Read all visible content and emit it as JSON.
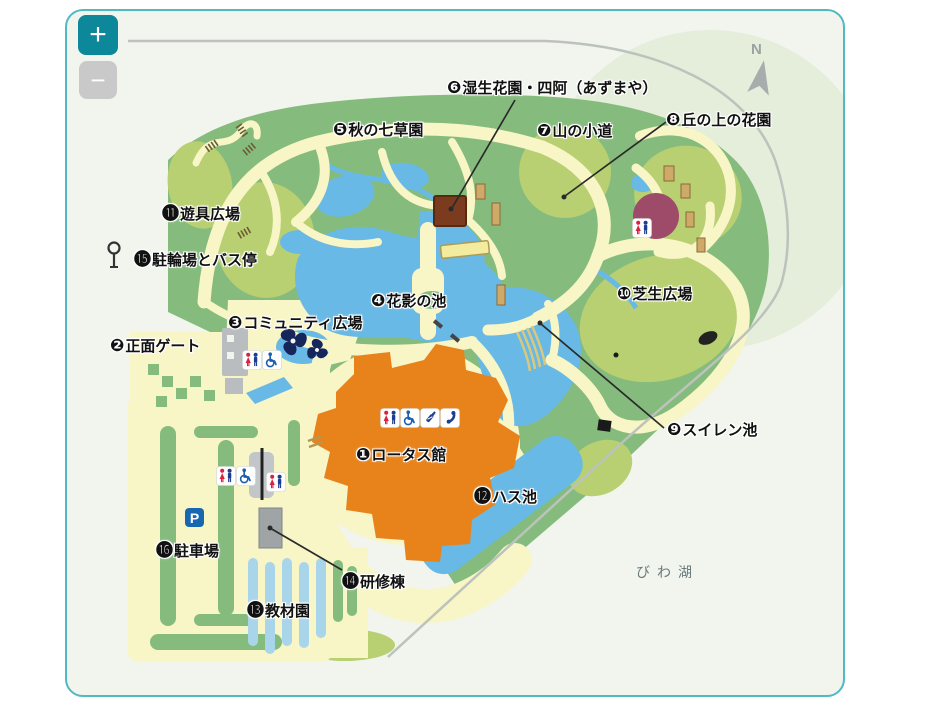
{
  "widget": {
    "zoom_in_label": "+",
    "zoom_out_label": "−"
  },
  "compass": {
    "letter": "N"
  },
  "map": {
    "parking_sign": "P",
    "lake_label": {
      "text": "びわ湖",
      "x": 636,
      "y": 562
    },
    "labels": [
      {
        "id": 1,
        "glyph": "❶",
        "text": "ロータス館",
        "x": 356,
        "y": 444
      },
      {
        "id": 2,
        "glyph": "❷",
        "text": "正面ゲート",
        "x": 110,
        "y": 335
      },
      {
        "id": 3,
        "glyph": "❸",
        "text": "コミュニティ広場",
        "x": 228,
        "y": 312
      },
      {
        "id": 4,
        "glyph": "❹",
        "text": "花影の池",
        "x": 371,
        "y": 290
      },
      {
        "id": 5,
        "glyph": "❺",
        "text": "秋の七草園",
        "x": 333,
        "y": 119
      },
      {
        "id": 6,
        "glyph": "❻",
        "text": "湿生花園・四阿（あずまや）",
        "x": 447,
        "y": 77
      },
      {
        "id": 7,
        "glyph": "❼",
        "text": "山の小道",
        "x": 537,
        "y": 120
      },
      {
        "id": 8,
        "glyph": "❽",
        "text": "丘の上の花園",
        "x": 666,
        "y": 109
      },
      {
        "id": 9,
        "glyph": "❾",
        "text": "スイレン池",
        "x": 667,
        "y": 419
      },
      {
        "id": 10,
        "glyph": "❿",
        "text": "芝生広場",
        "x": 617,
        "y": 283
      },
      {
        "id": 11,
        "glyph": "⓫",
        "text": "遊具広場",
        "x": 162,
        "y": 199
      },
      {
        "id": 12,
        "glyph": "⓬",
        "text": "ハス池",
        "x": 474,
        "y": 482
      },
      {
        "id": 13,
        "glyph": "⓭",
        "text": "教材園",
        "x": 247,
        "y": 596
      },
      {
        "id": 14,
        "glyph": "⓮",
        "text": "研修棟",
        "x": 342,
        "y": 567
      },
      {
        "id": 15,
        "glyph": "⓯",
        "text": "駐輪場とバス停",
        "x": 134,
        "y": 245
      },
      {
        "id": 16,
        "glyph": "⓰",
        "text": "駐車場",
        "x": 156,
        "y": 536
      }
    ],
    "icons": [
      {
        "type": "toilet",
        "x": 242,
        "y": 350
      },
      {
        "type": "wheelchair",
        "x": 262,
        "y": 350
      },
      {
        "type": "toilet",
        "x": 380,
        "y": 408
      },
      {
        "type": "wheelchair",
        "x": 400,
        "y": 408
      },
      {
        "type": "bottle",
        "x": 420,
        "y": 408
      },
      {
        "type": "phone",
        "x": 440,
        "y": 408
      },
      {
        "type": "toilet",
        "x": 632,
        "y": 218
      },
      {
        "type": "toilet",
        "x": 216,
        "y": 466
      },
      {
        "type": "wheelchair",
        "x": 236,
        "y": 466
      },
      {
        "type": "toilet",
        "x": 266,
        "y": 472
      }
    ],
    "colors": {
      "widget_border": "#4fb9c4",
      "widget_bg": "#f1f5ee",
      "zoom_in_bg": "#0d879a",
      "zoom_out_bg": "#c9c9c9",
      "green": "#85bc7d",
      "light_green": "#b8cf72",
      "path_yellow": "#f8f5c6",
      "pond_blue": "#68b9e5",
      "building_orange": "#e8831c",
      "azumaya_brown": "#7b3b1e",
      "dome_purple": "#9d4b69",
      "parking_blue": "#1767b1",
      "toilet_red": "#d62440",
      "toilet_blue": "#1c3e92"
    }
  }
}
